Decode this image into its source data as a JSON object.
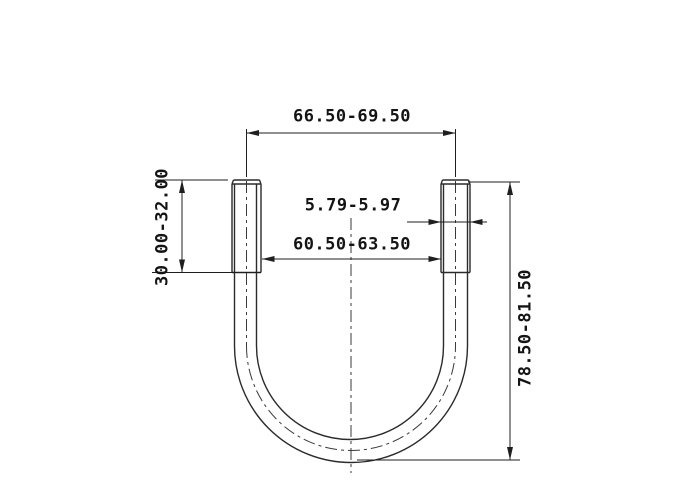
{
  "drawing": {
    "type": "u-bolt-dimension-drawing",
    "dimensions": {
      "outer_width": "66.50-69.50",
      "rod_diameter": "5.79-5.97",
      "inner_width": "60.50-63.50",
      "thread_length": "30.00-32.00",
      "total_height": "78.50-81.50"
    },
    "colors": {
      "part_line": "#2b2b2b",
      "dim_line": "#1f1f1f",
      "centerline": "#3a3a3a",
      "text": "#141414",
      "background": "#ffffff"
    }
  }
}
